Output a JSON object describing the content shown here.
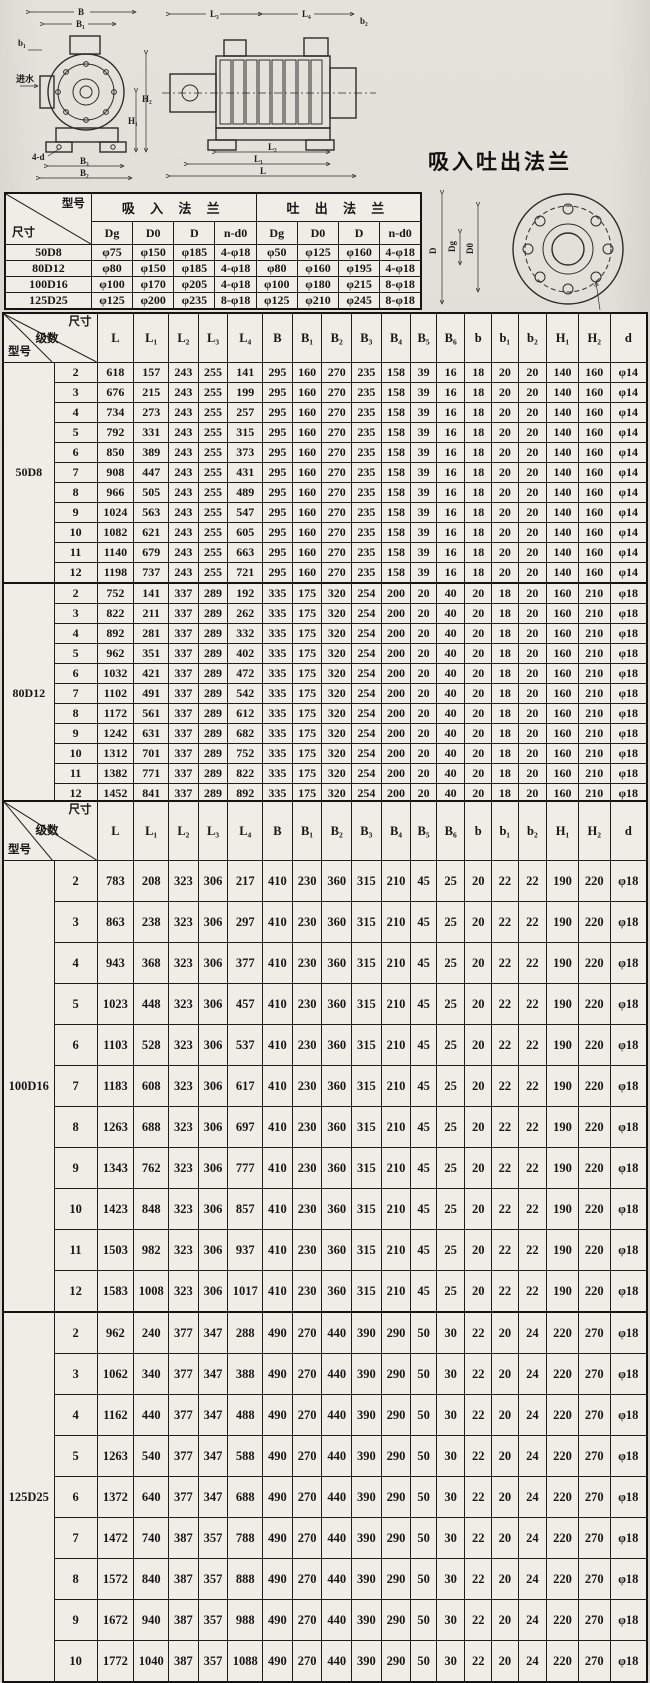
{
  "drawings": {
    "front": {
      "B": "B",
      "B1": "B₁",
      "b1": "b₁",
      "inlet": "进水",
      "H1": "H₁",
      "H2": "H₂",
      "fourd": "4-d",
      "B3": "B₃",
      "B2": "B₂"
    },
    "side": {
      "L3": "L₃",
      "L4": "L₄",
      "b2": "b₂",
      "L2": "L₂",
      "L1": "L₁",
      "L": "L"
    },
    "flange": {
      "title": "吸入吐出法兰",
      "D": "D",
      "Dg": "Dg",
      "D0": "D0",
      "nd0": "n-d0"
    }
  },
  "flange_table": {
    "corner_top": "型号",
    "corner_bottom": "尺寸",
    "group_headers": [
      "吸 入 法 兰",
      "吐 出 法 兰"
    ],
    "sub_headers": [
      "Dg",
      "D0",
      "D",
      "n-d0",
      "Dg",
      "D0",
      "D",
      "n-d0"
    ],
    "rows": [
      {
        "model": "50D8",
        "values": [
          "φ75",
          "φ150",
          "φ185",
          "4-φ18",
          "φ50",
          "φ125",
          "φ160",
          "4-φ18"
        ]
      },
      {
        "model": "80D12",
        "values": [
          "φ80",
          "φ150",
          "φ185",
          "4-φ18",
          "φ80",
          "φ160",
          "φ195",
          "4-φ18"
        ]
      },
      {
        "model": "100D16",
        "values": [
          "φ100",
          "φ170",
          "φ205",
          "4-φ18",
          "φ100",
          "φ180",
          "φ215",
          "8-φ18"
        ]
      },
      {
        "model": "125D25",
        "values": [
          "φ125",
          "φ200",
          "φ235",
          "8-φ18",
          "φ125",
          "φ210",
          "φ245",
          "8-φ18"
        ]
      }
    ]
  },
  "dim_table_1": {
    "corner": {
      "model": "型号",
      "stages": "级数",
      "size": "尺寸"
    },
    "columns": [
      "L",
      "L₁",
      "L₂",
      "L₃",
      "L₄",
      "B",
      "B₁",
      "B₂",
      "B₃",
      "B₄",
      "B₅",
      "B₆",
      "b",
      "b₁",
      "b₂",
      "H₁",
      "H₂",
      "d"
    ],
    "sections": [
      {
        "model": "50D8",
        "rows": [
          [
            2,
            618,
            157,
            243,
            255,
            141,
            295,
            160,
            270,
            235,
            158,
            39,
            16,
            18,
            20,
            20,
            140,
            160,
            "φ14"
          ],
          [
            3,
            676,
            215,
            243,
            255,
            199,
            295,
            160,
            270,
            235,
            158,
            39,
            16,
            18,
            20,
            20,
            140,
            160,
            "φ14"
          ],
          [
            4,
            734,
            273,
            243,
            255,
            257,
            295,
            160,
            270,
            235,
            158,
            39,
            16,
            18,
            20,
            20,
            140,
            160,
            "φ14"
          ],
          [
            5,
            792,
            331,
            243,
            255,
            315,
            295,
            160,
            270,
            235,
            158,
            39,
            16,
            18,
            20,
            20,
            140,
            160,
            "φ14"
          ],
          [
            6,
            850,
            389,
            243,
            255,
            373,
            295,
            160,
            270,
            235,
            158,
            39,
            16,
            18,
            20,
            20,
            140,
            160,
            "φ14"
          ],
          [
            7,
            908,
            447,
            243,
            255,
            431,
            295,
            160,
            270,
            235,
            158,
            39,
            16,
            18,
            20,
            20,
            140,
            160,
            "φ14"
          ],
          [
            8,
            966,
            505,
            243,
            255,
            489,
            295,
            160,
            270,
            235,
            158,
            39,
            16,
            18,
            20,
            20,
            140,
            160,
            "φ14"
          ],
          [
            9,
            1024,
            563,
            243,
            255,
            547,
            295,
            160,
            270,
            235,
            158,
            39,
            16,
            18,
            20,
            20,
            140,
            160,
            "φ14"
          ],
          [
            10,
            1082,
            621,
            243,
            255,
            605,
            295,
            160,
            270,
            235,
            158,
            39,
            16,
            18,
            20,
            20,
            140,
            160,
            "φ14"
          ],
          [
            11,
            1140,
            679,
            243,
            255,
            663,
            295,
            160,
            270,
            235,
            158,
            39,
            16,
            18,
            20,
            20,
            140,
            160,
            "φ14"
          ],
          [
            12,
            1198,
            737,
            243,
            255,
            721,
            295,
            160,
            270,
            235,
            158,
            39,
            16,
            18,
            20,
            20,
            140,
            160,
            "φ14"
          ]
        ]
      },
      {
        "model": "80D12",
        "rows": [
          [
            2,
            752,
            141,
            337,
            289,
            192,
            335,
            175,
            320,
            254,
            200,
            20,
            40,
            20,
            18,
            20,
            160,
            210,
            "φ18"
          ],
          [
            3,
            822,
            211,
            337,
            289,
            262,
            335,
            175,
            320,
            254,
            200,
            20,
            40,
            20,
            18,
            20,
            160,
            210,
            "φ18"
          ],
          [
            4,
            892,
            281,
            337,
            289,
            332,
            335,
            175,
            320,
            254,
            200,
            20,
            40,
            20,
            18,
            20,
            160,
            210,
            "φ18"
          ],
          [
            5,
            962,
            351,
            337,
            289,
            402,
            335,
            175,
            320,
            254,
            200,
            20,
            40,
            20,
            18,
            20,
            160,
            210,
            "φ18"
          ],
          [
            6,
            1032,
            421,
            337,
            289,
            472,
            335,
            175,
            320,
            254,
            200,
            20,
            40,
            20,
            18,
            20,
            160,
            210,
            "φ18"
          ],
          [
            7,
            1102,
            491,
            337,
            289,
            542,
            335,
            175,
            320,
            254,
            200,
            20,
            40,
            20,
            18,
            20,
            160,
            210,
            "φ18"
          ],
          [
            8,
            1172,
            561,
            337,
            289,
            612,
            335,
            175,
            320,
            254,
            200,
            20,
            40,
            20,
            18,
            20,
            160,
            210,
            "φ18"
          ],
          [
            9,
            1242,
            631,
            337,
            289,
            682,
            335,
            175,
            320,
            254,
            200,
            20,
            40,
            20,
            18,
            20,
            160,
            210,
            "φ18"
          ],
          [
            10,
            1312,
            701,
            337,
            289,
            752,
            335,
            175,
            320,
            254,
            200,
            20,
            40,
            20,
            18,
            20,
            160,
            210,
            "φ18"
          ],
          [
            11,
            1382,
            771,
            337,
            289,
            822,
            335,
            175,
            320,
            254,
            200,
            20,
            40,
            20,
            18,
            20,
            160,
            210,
            "φ18"
          ],
          [
            12,
            1452,
            841,
            337,
            289,
            892,
            335,
            175,
            320,
            254,
            200,
            20,
            40,
            20,
            18,
            20,
            160,
            210,
            "φ18"
          ]
        ]
      }
    ]
  },
  "dim_table_2": {
    "corner": {
      "model": "型号",
      "stages": "级数",
      "size": "尺寸"
    },
    "columns": [
      "L",
      "L₁",
      "L₂",
      "L₃",
      "L₄",
      "B",
      "B₁",
      "B₂",
      "B₃",
      "B₄",
      "B₅",
      "B₆",
      "b",
      "b₁",
      "b₂",
      "H₁",
      "H₂",
      "d"
    ],
    "sections": [
      {
        "model": "100D16",
        "rows": [
          [
            2,
            783,
            208,
            323,
            306,
            217,
            410,
            230,
            360,
            315,
            210,
            45,
            25,
            20,
            22,
            22,
            190,
            220,
            "φ18"
          ],
          [
            3,
            863,
            238,
            323,
            306,
            297,
            410,
            230,
            360,
            315,
            210,
            45,
            25,
            20,
            22,
            22,
            190,
            220,
            "φ18"
          ],
          [
            4,
            943,
            368,
            323,
            306,
            377,
            410,
            230,
            360,
            315,
            210,
            45,
            25,
            20,
            22,
            22,
            190,
            220,
            "φ18"
          ],
          [
            5,
            1023,
            448,
            323,
            306,
            457,
            410,
            230,
            360,
            315,
            210,
            45,
            25,
            20,
            22,
            22,
            190,
            220,
            "φ18"
          ],
          [
            6,
            1103,
            528,
            323,
            306,
            537,
            410,
            230,
            360,
            315,
            210,
            45,
            25,
            20,
            22,
            22,
            190,
            220,
            "φ18"
          ],
          [
            7,
            1183,
            608,
            323,
            306,
            617,
            410,
            230,
            360,
            315,
            210,
            45,
            25,
            20,
            22,
            22,
            190,
            220,
            "φ18"
          ],
          [
            8,
            1263,
            688,
            323,
            306,
            697,
            410,
            230,
            360,
            315,
            210,
            45,
            25,
            20,
            22,
            22,
            190,
            220,
            "φ18"
          ],
          [
            9,
            1343,
            762,
            323,
            306,
            777,
            410,
            230,
            360,
            315,
            210,
            45,
            25,
            20,
            22,
            22,
            190,
            220,
            "φ18"
          ],
          [
            10,
            1423,
            848,
            323,
            306,
            857,
            410,
            230,
            360,
            315,
            210,
            45,
            25,
            20,
            22,
            22,
            190,
            220,
            "φ18"
          ],
          [
            11,
            1503,
            982,
            323,
            306,
            937,
            410,
            230,
            360,
            315,
            210,
            45,
            25,
            20,
            22,
            22,
            190,
            220,
            "φ18"
          ],
          [
            12,
            1583,
            1008,
            323,
            306,
            1017,
            410,
            230,
            360,
            315,
            210,
            45,
            25,
            20,
            22,
            22,
            190,
            220,
            "φ18"
          ]
        ]
      },
      {
        "model": "125D25",
        "rows": [
          [
            2,
            962,
            240,
            377,
            347,
            288,
            490,
            270,
            440,
            390,
            290,
            50,
            30,
            22,
            20,
            24,
            220,
            270,
            "φ18"
          ],
          [
            3,
            1062,
            340,
            377,
            347,
            388,
            490,
            270,
            440,
            390,
            290,
            50,
            30,
            22,
            20,
            24,
            220,
            270,
            "φ18"
          ],
          [
            4,
            1162,
            440,
            377,
            347,
            488,
            490,
            270,
            440,
            390,
            290,
            50,
            30,
            22,
            20,
            24,
            220,
            270,
            "φ18"
          ],
          [
            5,
            1263,
            540,
            377,
            347,
            588,
            490,
            270,
            440,
            390,
            290,
            50,
            30,
            22,
            20,
            24,
            220,
            270,
            "φ18"
          ],
          [
            6,
            1372,
            640,
            377,
            347,
            688,
            490,
            270,
            440,
            390,
            290,
            50,
            30,
            22,
            20,
            24,
            220,
            270,
            "φ18"
          ],
          [
            7,
            1472,
            740,
            387,
            357,
            788,
            490,
            270,
            440,
            390,
            290,
            50,
            30,
            22,
            20,
            24,
            220,
            270,
            "φ18"
          ],
          [
            8,
            1572,
            840,
            387,
            357,
            888,
            490,
            270,
            440,
            390,
            290,
            50,
            30,
            22,
            20,
            24,
            220,
            270,
            "φ18"
          ],
          [
            9,
            1672,
            940,
            387,
            357,
            988,
            490,
            270,
            440,
            390,
            290,
            50,
            30,
            22,
            20,
            24,
            220,
            270,
            "φ18"
          ],
          [
            10,
            1772,
            1040,
            387,
            357,
            1088,
            490,
            270,
            440,
            390,
            290,
            50,
            30,
            22,
            20,
            24,
            220,
            270,
            "φ18"
          ]
        ]
      }
    ]
  }
}
